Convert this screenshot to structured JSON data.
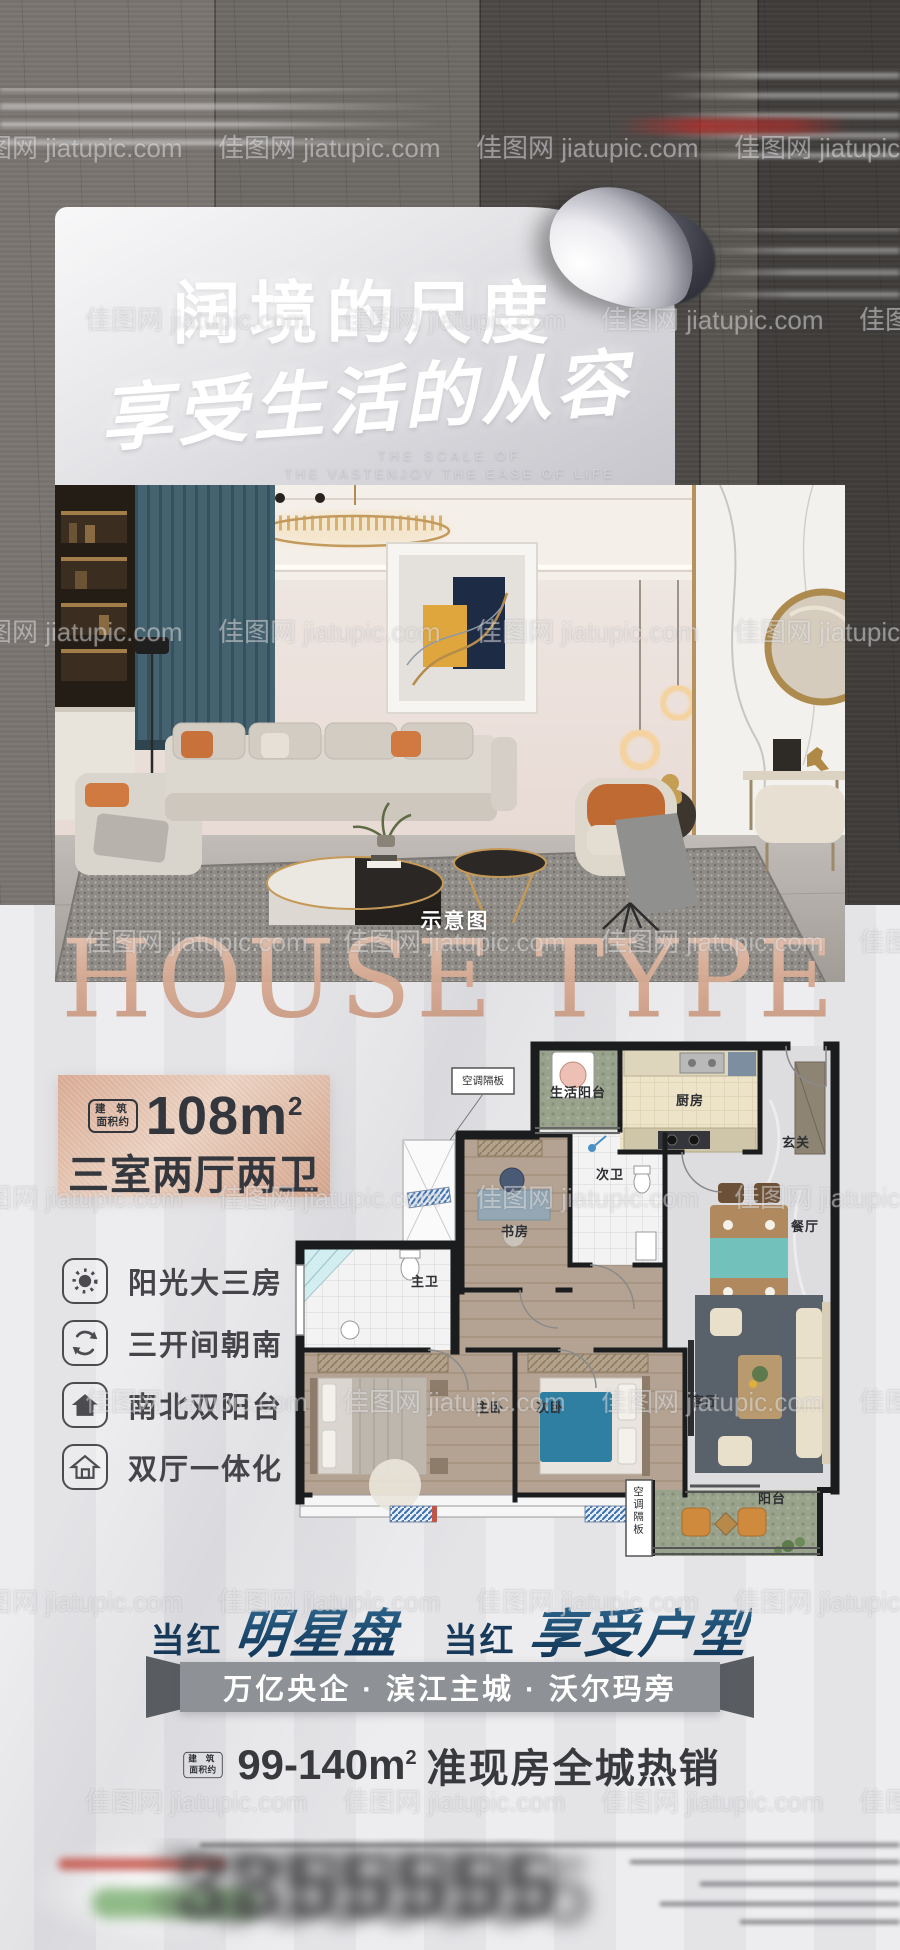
{
  "watermark": {
    "text": "佳图网 jiatupic.com"
  },
  "header": {
    "title": "阔境的尺度",
    "calligraphy": "享受生活的从容",
    "subtitle_en_1": "THE SCALE OF",
    "subtitle_en_2": "THE VASTENJOY THE EASE OF LIFE"
  },
  "photo": {
    "caption": "示意图"
  },
  "house_type": {
    "text": "HOUSE TYPE"
  },
  "area_panel": {
    "tag_1": "建 筑",
    "tag_2": "面积约",
    "value": "108m",
    "sup": "2",
    "layout": "三室两厅两卫"
  },
  "features": [
    {
      "icon": "sun-icon",
      "label": "阳光大三房"
    },
    {
      "icon": "refresh-icon",
      "label": "三开间朝南"
    },
    {
      "icon": "house-filled-icon",
      "label": "南北双阳台"
    },
    {
      "icon": "house-outline-icon",
      "label": "双厅一体化"
    }
  ],
  "floor_plan": {
    "labels": {
      "ac_top": "空调隔板",
      "life_balcony": "生活阳台",
      "kitchen": "厨房",
      "entry": "玄关",
      "bath2": "次卫",
      "study": "书房",
      "dining": "餐厅",
      "bath1": "主卫",
      "master": "主卧",
      "second": "次卧",
      "living": "客厅",
      "ac_bottom": "空调隔板",
      "balcony": "阳台"
    }
  },
  "slogan": {
    "t1": "当红",
    "t2": "明星盘",
    "t3": "当红",
    "t4": "享受户型"
  },
  "ribbon": {
    "text": "万亿央企 · 滨江主城 · 沃尔玛旁"
  },
  "sales": {
    "tag_1": "建 筑",
    "tag_2": "面积约",
    "range": "99-140m",
    "sup": "2",
    "text": "准现房全城热销"
  },
  "footer": {
    "number": "3355555"
  }
}
